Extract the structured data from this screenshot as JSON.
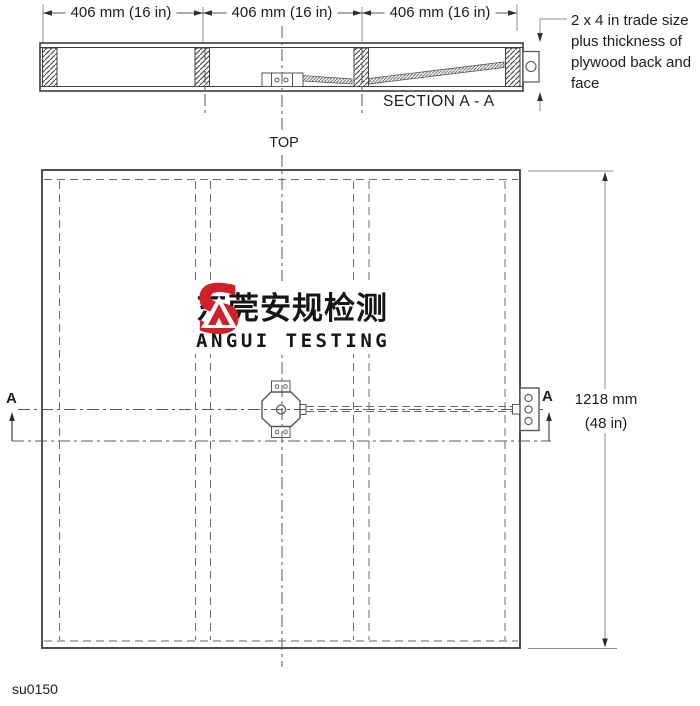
{
  "drawing": {
    "code": "su0150",
    "top_label": "TOP",
    "section_label": "SECTION A - A",
    "cut_marker_left": "A",
    "cut_marker_right": "A",
    "width_dims": [
      "406 mm (16 in)",
      "406 mm (16 in)",
      "406 mm (16 in)"
    ],
    "height_dim_line1": "1218 mm",
    "height_dim_line2": "(48 in)",
    "note_lines": [
      "2 x 4 in trade size",
      "plus thickness of",
      "plywood back and",
      "face"
    ]
  },
  "logo": {
    "mark": "S",
    "chinese": "东莞安规检测",
    "english": "ANGUI TESTING",
    "accent_color": "#d0202a"
  },
  "colors": {
    "main_line": "#3d3d3d",
    "medium_line": "#555555",
    "hidden_line": "#6a6a6a",
    "dim_line": "#8f8f8f",
    "arrow": "#2e2e2e"
  }
}
